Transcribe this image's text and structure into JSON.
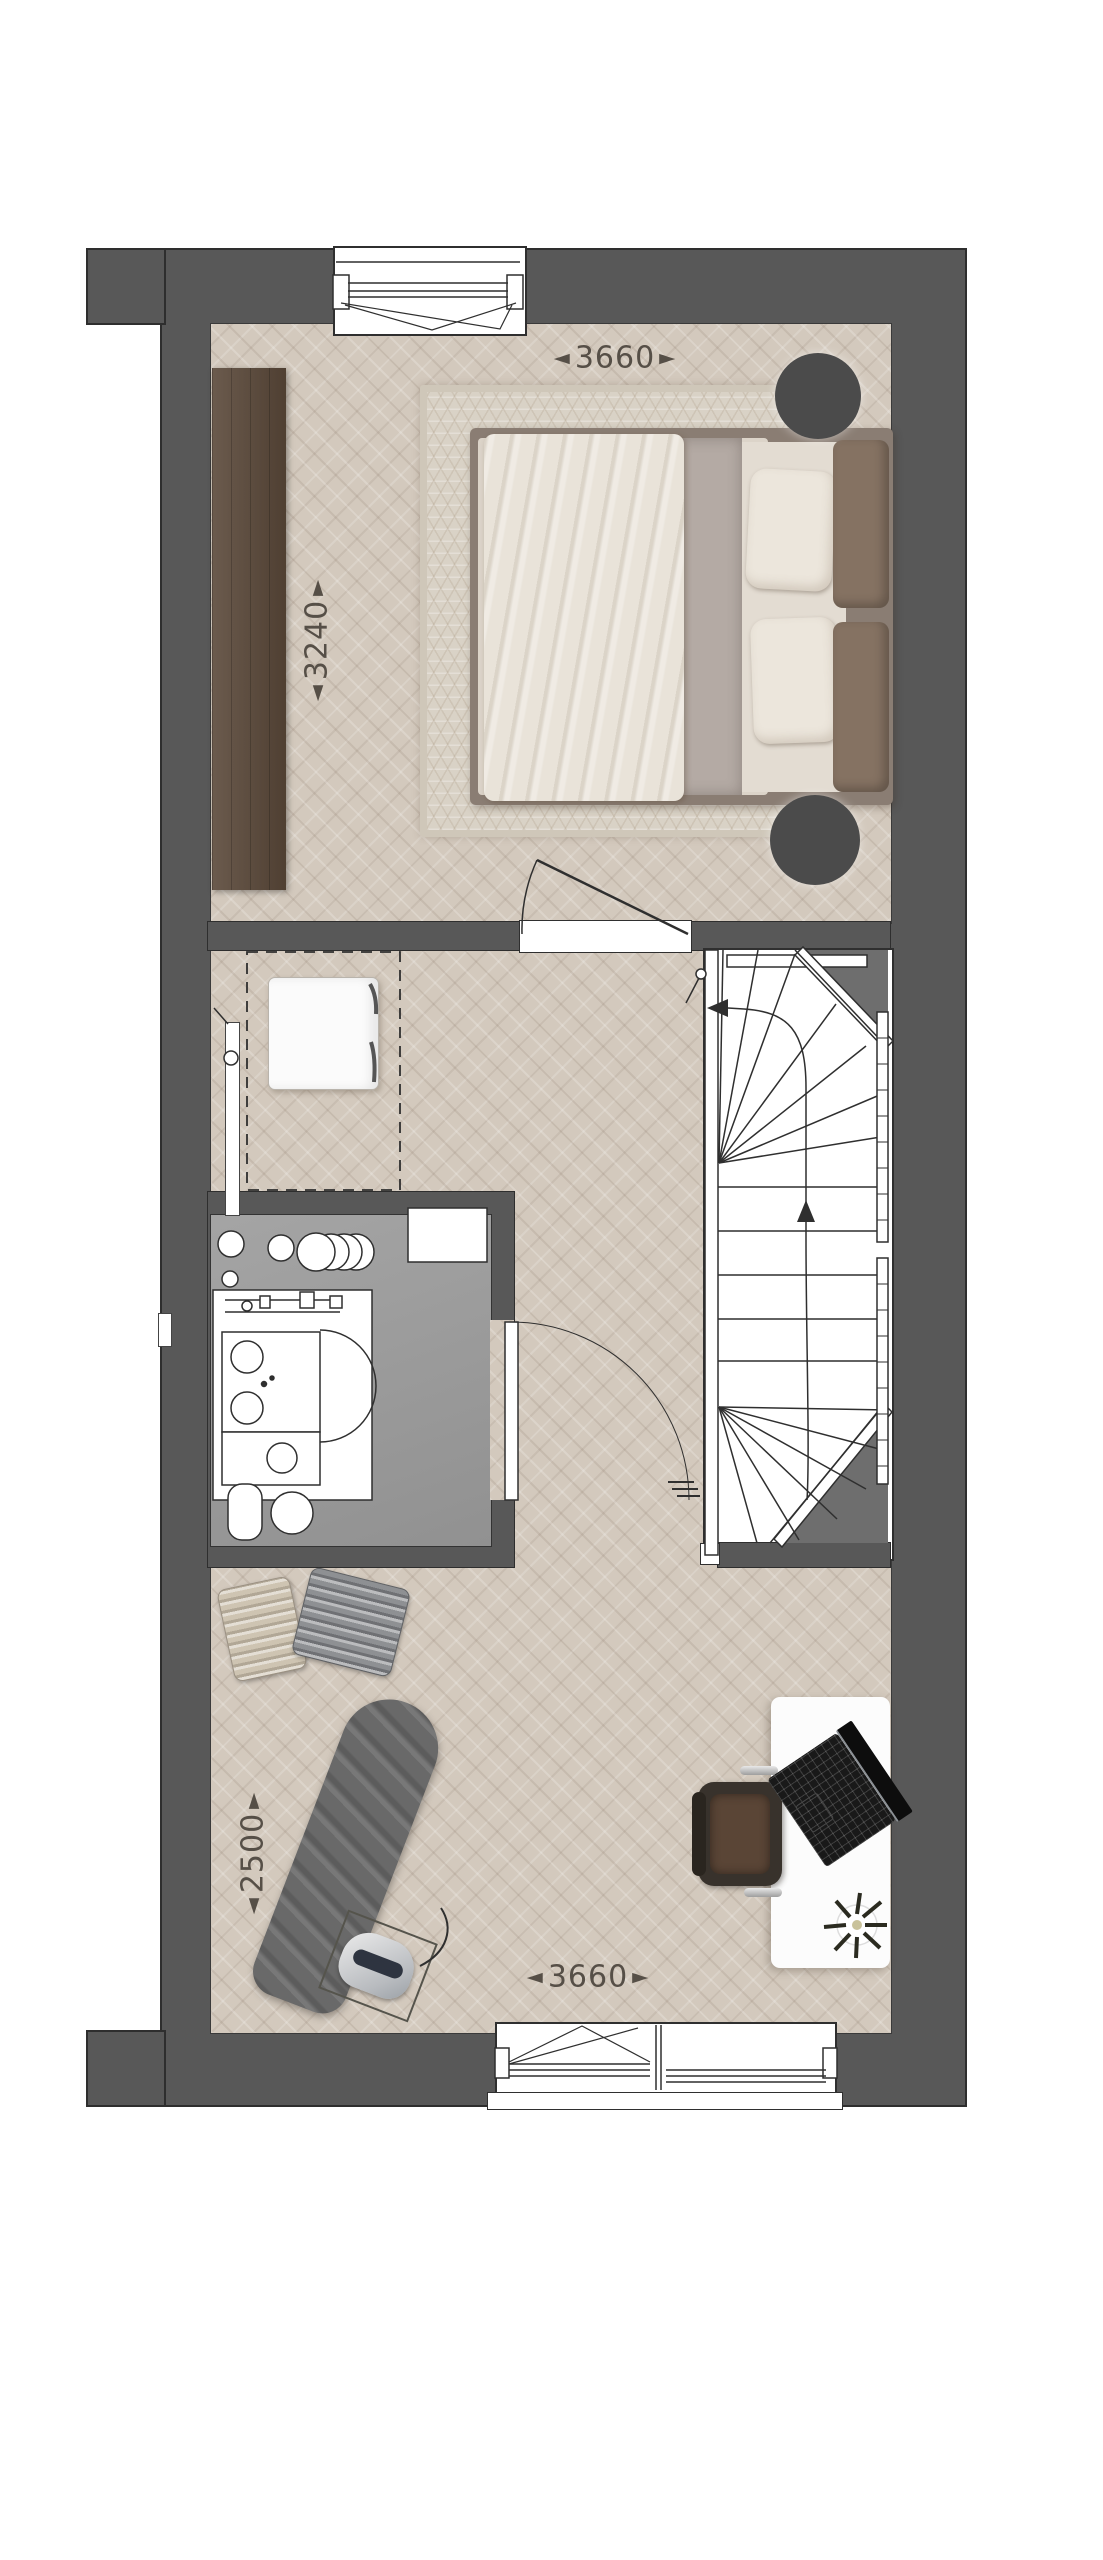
{
  "plan": {
    "title": "upper-floor plan",
    "arrow_left_glyph": "◄",
    "arrow_right_glyph": "►",
    "dimensions": {
      "top": {
        "value": "3660"
      },
      "left": {
        "value": "3240"
      },
      "lower_left": {
        "value": "2500"
      },
      "bottom": {
        "value": "3660"
      }
    }
  },
  "colors": {
    "wall": "#585858",
    "wall-line": "#2e2e2e",
    "wedge": "#6e6e6e",
    "floor-wood": "#d3c9bd",
    "floor-tech": "#9a9a9a",
    "line": "#2f2f2f",
    "label": "#564f47",
    "wardrobe": "#5a4839",
    "rug": "#d9d2c6",
    "bed-frame": "#8a7d73",
    "duvet": "#e9e3d9",
    "pillow": "#ece6dc",
    "headboard": "#857262",
    "nightstand": "#4b4b4b",
    "chair-dark": "#38322c",
    "chair-seat": "#5a4536",
    "board": "#696969",
    "case-light": "#cec4b2",
    "case-gray": "#8e9093",
    "laptop": "#191919"
  }
}
